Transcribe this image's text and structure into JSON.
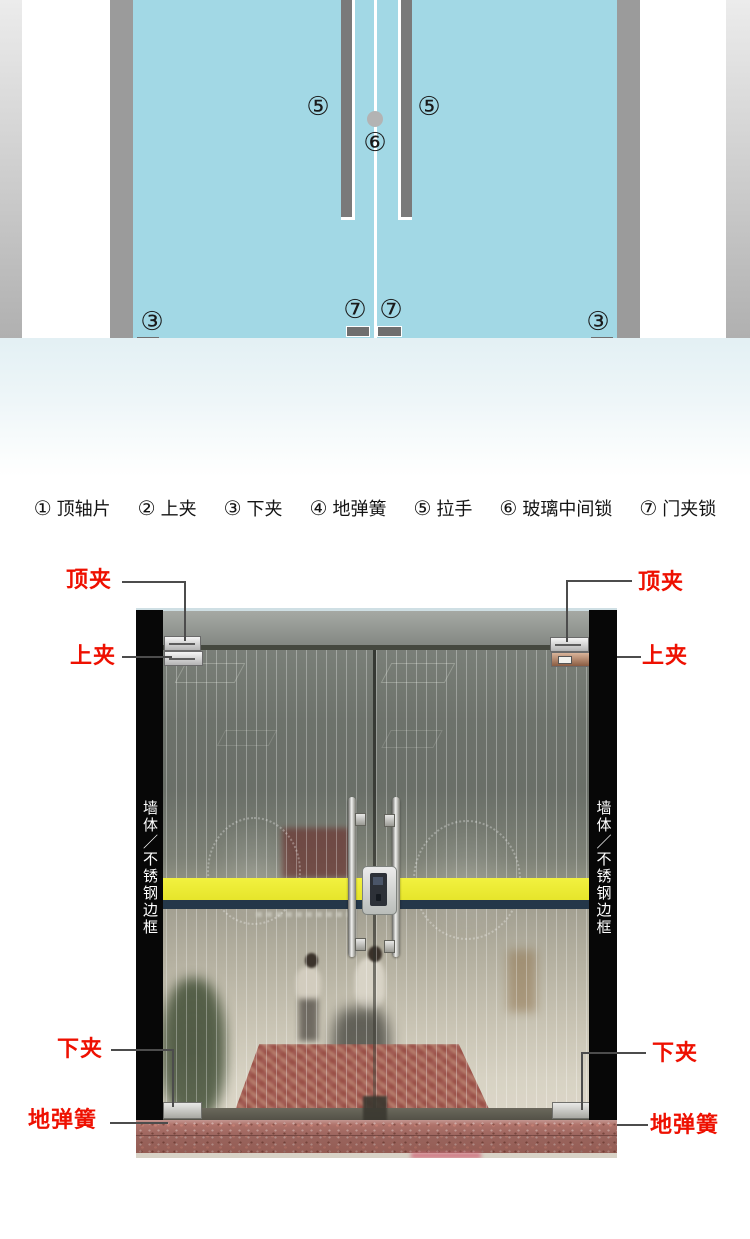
{
  "legend": {
    "items": [
      {
        "num": "①",
        "label": "顶轴片"
      },
      {
        "num": "②",
        "label": "上夹"
      },
      {
        "num": "③",
        "label": "下夹"
      },
      {
        "num": "④",
        "label": "地弹簧"
      },
      {
        "num": "⑤",
        "label": "拉手"
      },
      {
        "num": "⑥",
        "label": "玻璃中间锁"
      },
      {
        "num": "⑦",
        "label": "门夹锁"
      }
    ]
  },
  "diagram": {
    "callouts": {
      "handle_left": "⑤",
      "handle_right": "⑤",
      "center_lock": "⑥",
      "door_lock_left": "⑦",
      "door_lock_right": "⑦",
      "bottom_clamp_left": "③",
      "bottom_clamp_right": "③",
      "floor_spring_left": "④",
      "floor_spring_right": "④"
    },
    "colors": {
      "glass": "#a2d8e5",
      "column_gray": "#9b9b9b",
      "hardware_gray": "#6f6f6f",
      "handle_gray": "#7a7a7a",
      "floor_tint": "#e3f0f4"
    }
  },
  "photo": {
    "annotations": {
      "top_clamp_left": "顶夹",
      "top_clamp_right": "顶夹",
      "upper_clamp_left": "上夹",
      "upper_clamp_right": "上夹",
      "lower_clamp_left": "下夹",
      "lower_clamp_right": "下夹",
      "floor_spring_left": "地弹簧",
      "floor_spring_right": "地弹簧",
      "frame_left": "墙体／不锈钢边框",
      "frame_right": "墙体／不锈钢边框"
    },
    "colors": {
      "label_red": "#ee1001",
      "stripe_yellow": "#e6e52b",
      "stripe_navy": "#243749",
      "bar_black": "#070707"
    }
  }
}
